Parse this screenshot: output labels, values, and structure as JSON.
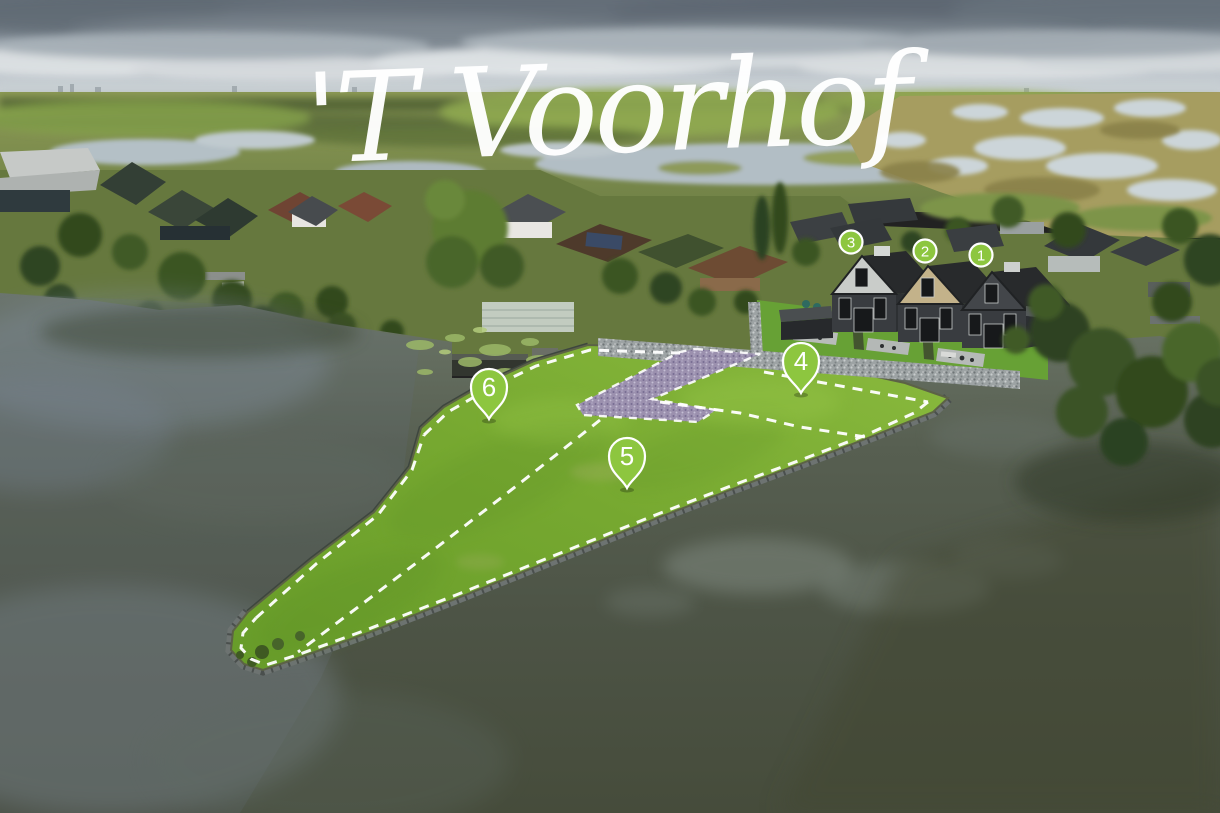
{
  "logo": {
    "text": "'T Voorhof"
  },
  "markers": {
    "houses": [
      {
        "label": "1",
        "shape": "circle"
      },
      {
        "label": "2",
        "shape": "circle"
      },
      {
        "label": "3",
        "shape": "circle"
      }
    ],
    "plots": [
      {
        "label": "4",
        "shape": "pin"
      },
      {
        "label": "5",
        "shape": "pin"
      },
      {
        "label": "6",
        "shape": "pin"
      }
    ]
  },
  "palette": {
    "marker_green": "#8dc63f",
    "marker_text": "#ffffff",
    "plot_outline_dash": "#ffffff",
    "peninsula_grass": "#74a42f",
    "lake_water": "#4e5548",
    "sky_gray": "#98a2ab"
  },
  "scene": {
    "type": "aerial-drone-photo",
    "description": "Aerial photo of the 'T Voorhof new-build development: three rendered houses numbered 1-3 beside the existing village, and three waterfront building plots numbered 4-6 outlined with white dashed lines on a grass peninsula in a lake, with marshland and fields on the horizon"
  }
}
